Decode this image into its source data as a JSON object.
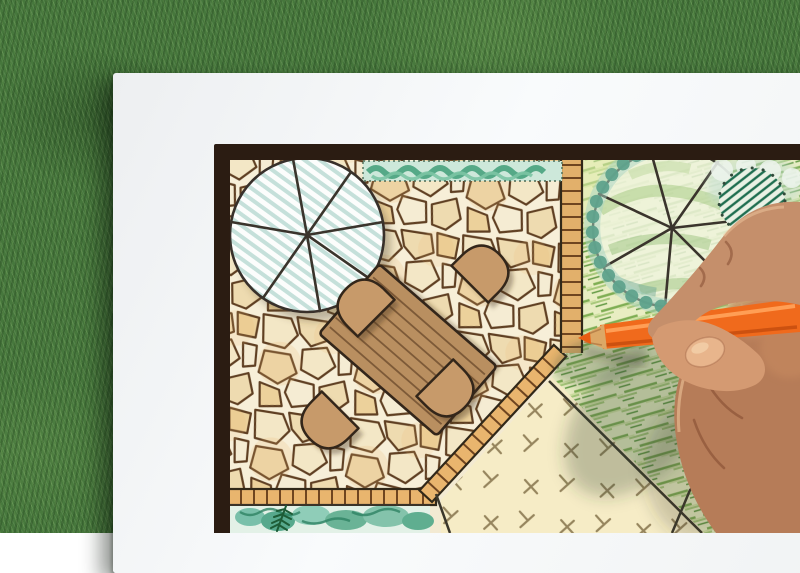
{
  "scene": {
    "description": "Photograph of a hand drawing a backyard landscape design plan in colored pencil on a white sheet of paper lying on green grass",
    "background": "Green grass lawn",
    "paper": "White sheet of paper",
    "plan": {
      "frame": "Dark hand-drawn plan border",
      "patio": "Irregular flagstone paved patio",
      "brick_edging": "Tan brick edging strips along patio and path",
      "table": "Rectangular wooden plank dining table, rotated diagonally",
      "chairs": "Four semicircular chairs around the table",
      "tree_left": "Large round tree canopy symbol with radial branch lines and teal hatching",
      "tree_right": "Round tree canopy symbol over lawn with radial branch lines and green shading",
      "shrub_scallops": "Scalloped shrub masses in teal green around right tree",
      "hatched_shrub": "Round shrub with dark green diagonal hatching, top right",
      "hedge": "Low green hedge strip along the top edge of the patio",
      "lawn": "Lawn area shaded with diagonal green crayon strokes",
      "ground_cover": "Sand-colored ground cover area with plus and dash texture marks",
      "planting_bed": "Teal watercolor planting bed with dark conifer sprig along bottom",
      "boulders": "Outlined stepping boulders over the lawn, bottom right",
      "accent_plants": "Small green plants with orange flower dots, bottom right corner"
    },
    "hand": "Right hand holding an orange colored pencil over the drawing",
    "pencil": "Orange colored pencil with sharpened wooden tip"
  },
  "colors": {
    "grass_base": "#46773c",
    "grass_dark": "#2e5729",
    "grass_light": "#8ab26c",
    "paper": "#f4f6f7",
    "frame": "#2b1c12",
    "stone_grout": "#f7efd8",
    "stone_line": "#5f3f22",
    "brick": "#e9b56e",
    "wood": "#b98f60",
    "wood_line": "#33261a",
    "tree_stripe": "#b7d9d1",
    "hedge": "#3f9e78",
    "lawn_base": "#e8edc2",
    "lawn_stroke": "#7fae54",
    "sand": "#f6ecc6",
    "sand_mark": "#8b7a52",
    "teal": "#5fa28c",
    "pencil": "#f06a1c",
    "pencil_dark": "#cc5110",
    "pencil_wood": "#dca866",
    "skin": "#b67c58",
    "skin_light": "#d49a72",
    "skin_dark": "#8f5a40"
  }
}
